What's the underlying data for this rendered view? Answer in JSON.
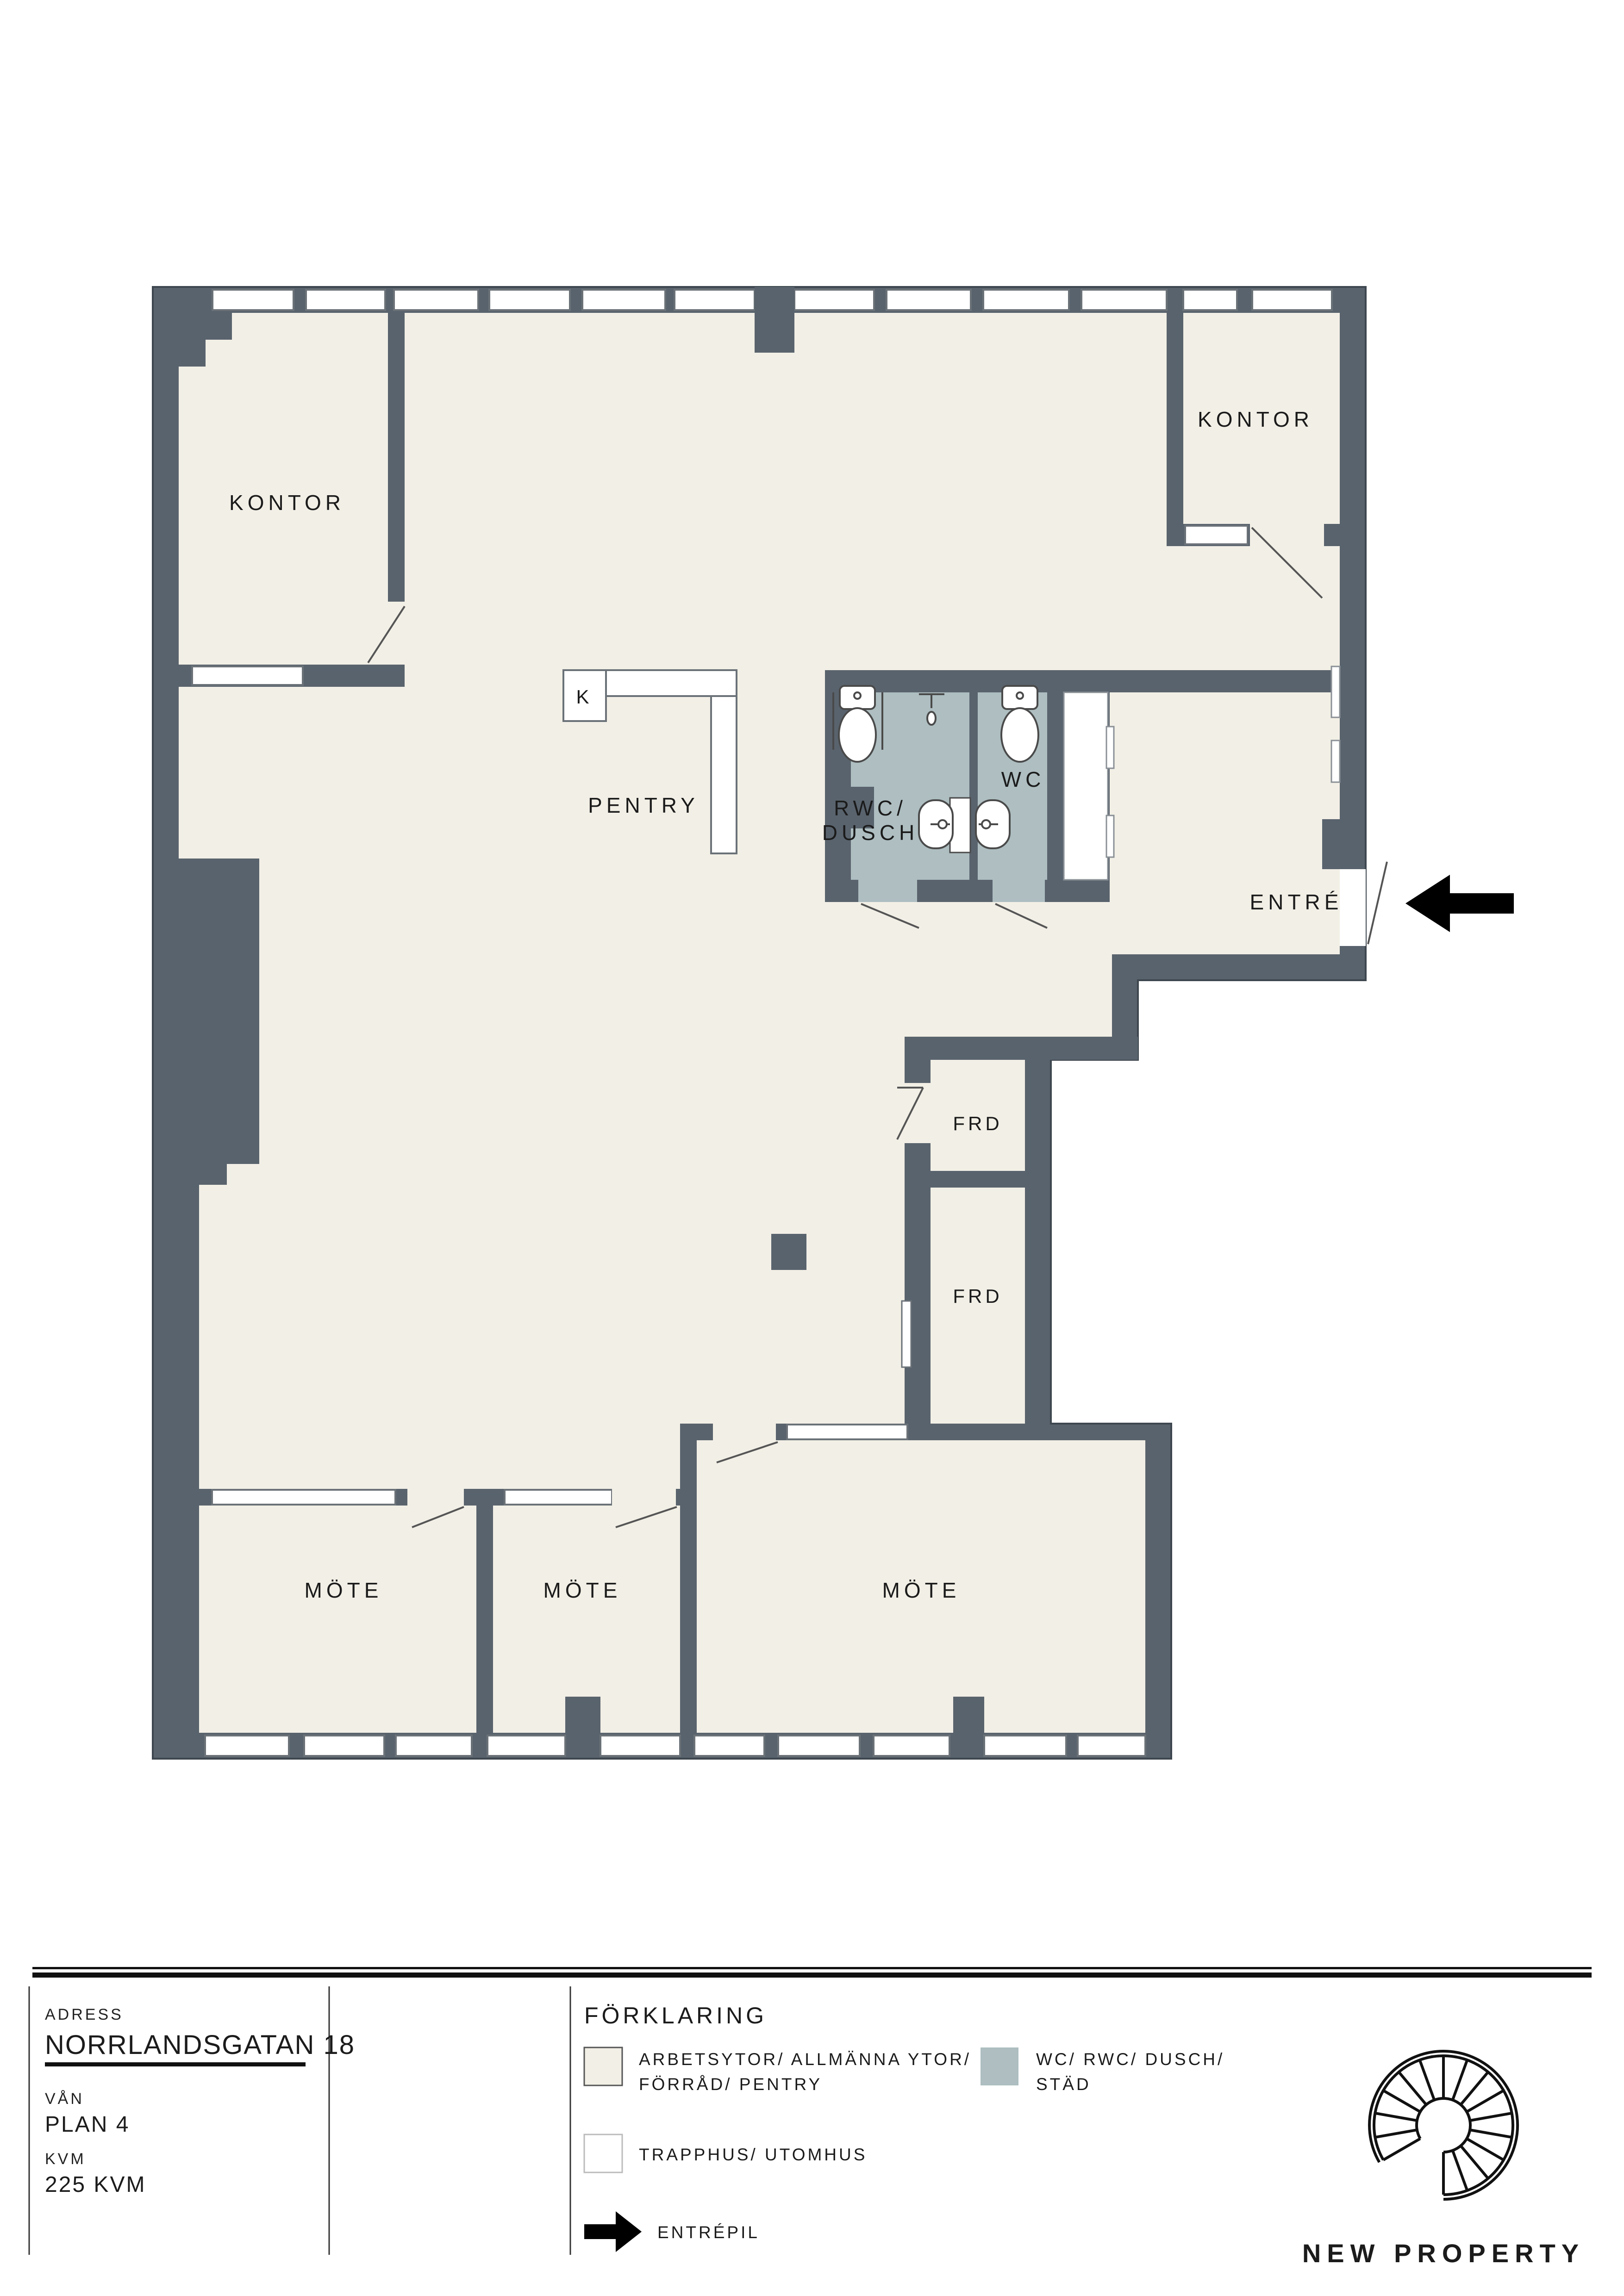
{
  "document": {
    "type": "floorplan",
    "language": "sv"
  },
  "colors": {
    "wall": "#59636D",
    "wall_outline": "#3E474F",
    "floor_work_areas": "#F2EFE6",
    "wet_rooms": "#AEBEC1",
    "stairwell_outdoor": "#FFFFFF",
    "arrow": "#000000"
  },
  "floorplan": {
    "rooms": {
      "kontor": "KONTOR",
      "pentry": "PENTRY",
      "kitchen": "K",
      "rwc_line1": "RWC/",
      "rwc_line2": "DUSCH",
      "wc": "WC",
      "entre": "ENTRÉ",
      "frd": "FRD",
      "mote": "MÖTE"
    }
  },
  "legend": {
    "title": "FÖRKLARING",
    "items": [
      {
        "swatch_color": "#F2EFE6",
        "label_line1": "ARBETSYTOR/ ALLMÄNNA YTOR/",
        "label_line2": "FÖRRÅD/ PENTRY"
      },
      {
        "swatch_color": "#AEBEC1",
        "label_line1": "WC/ RWC/ DUSCH/",
        "label_line2": "STÄD"
      },
      {
        "swatch_color": "#FFFFFF",
        "label_line1": "TRAPPHUS/ UTOMHUS",
        "label_line2": ""
      },
      {
        "swatch_color": "arrow",
        "label_line1": "ENTRÉPIL",
        "label_line2": ""
      }
    ]
  },
  "title_block": {
    "adress_label": "ADRESS",
    "adress_value": "NORRLANDSGATAN 18",
    "van_label": "VÅN",
    "van_value": "PLAN 4",
    "kvm_label": "KVM",
    "kvm_value": "225 KVM"
  },
  "brand": {
    "name": "NEW PROPERTY",
    "logo": "spiral-staircase-icon"
  }
}
